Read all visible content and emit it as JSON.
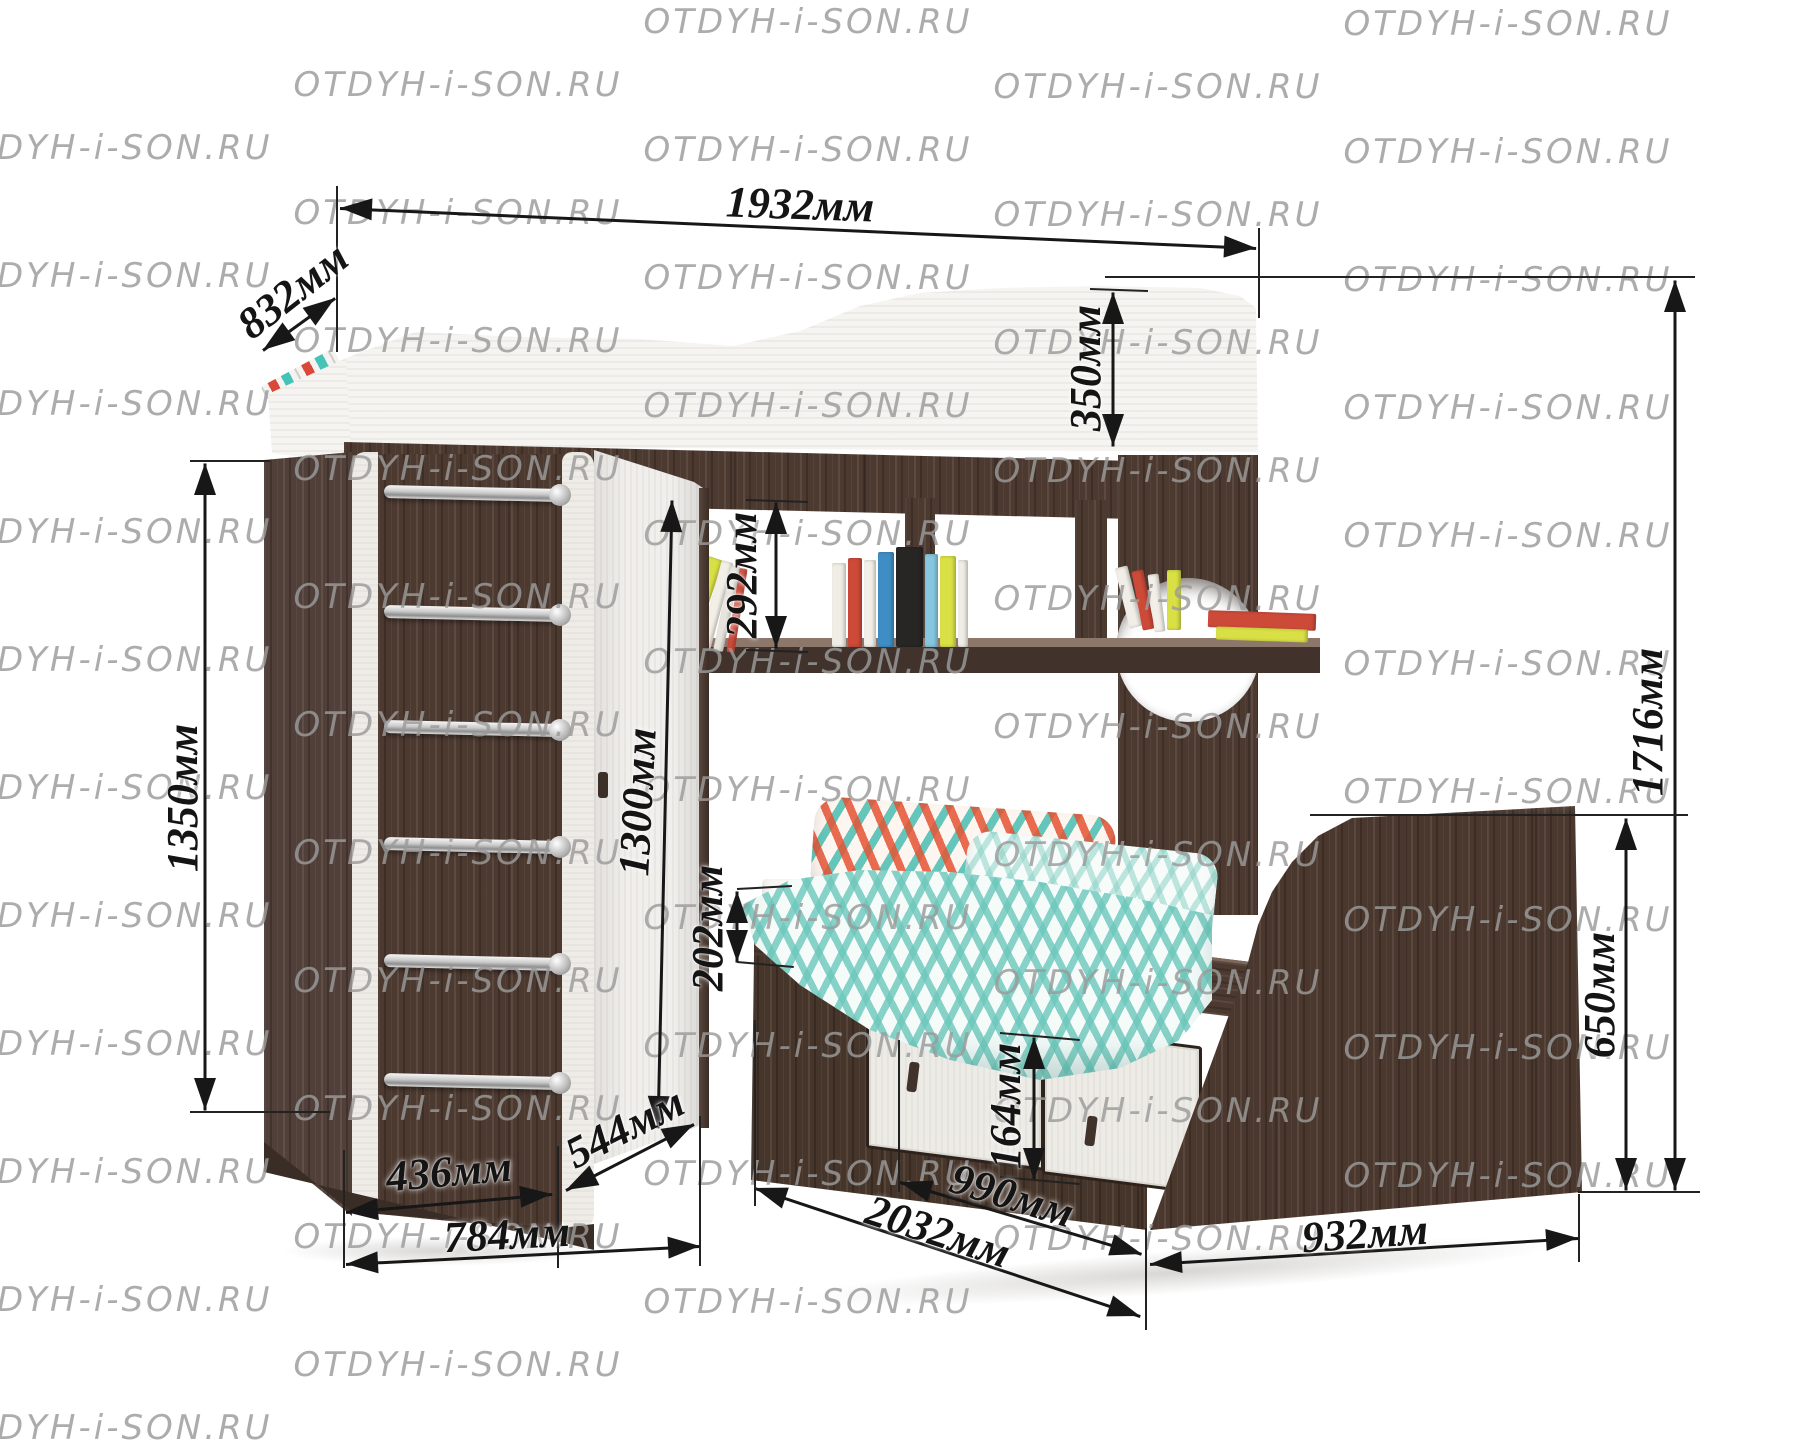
{
  "watermark": {
    "text": "OTDYH-i-SON.RU",
    "color": "#9b9b9b"
  },
  "colors": {
    "wood_dark": "#4c3a31",
    "panel_white": "#f5f4f1",
    "accent_teal": "#44c3b6",
    "accent_red": "#d9493a",
    "dimension_line": "#171717",
    "watermark_gray": "#9b9b9b"
  },
  "dimensions": {
    "upper_bed_length": "1932мм",
    "upper_bed_depth": "832мм",
    "upper_rail_height": "350мм",
    "total_height": "1716мм",
    "ladder_height": "1350мм",
    "shelf_opening_height": "292мм",
    "wardrobe_door_height": "1300мм",
    "bed_rail_height": "202мм",
    "drawer_height": "164мм",
    "footboard_height": "650мм",
    "ladder_section_depth": "436мм",
    "door_section_depth": "544мм",
    "wardrobe_total_depth": "784мм",
    "lower_bed_length": "2032мм",
    "drawer_section_width": "990мм",
    "lower_bed_width": "932мм"
  }
}
